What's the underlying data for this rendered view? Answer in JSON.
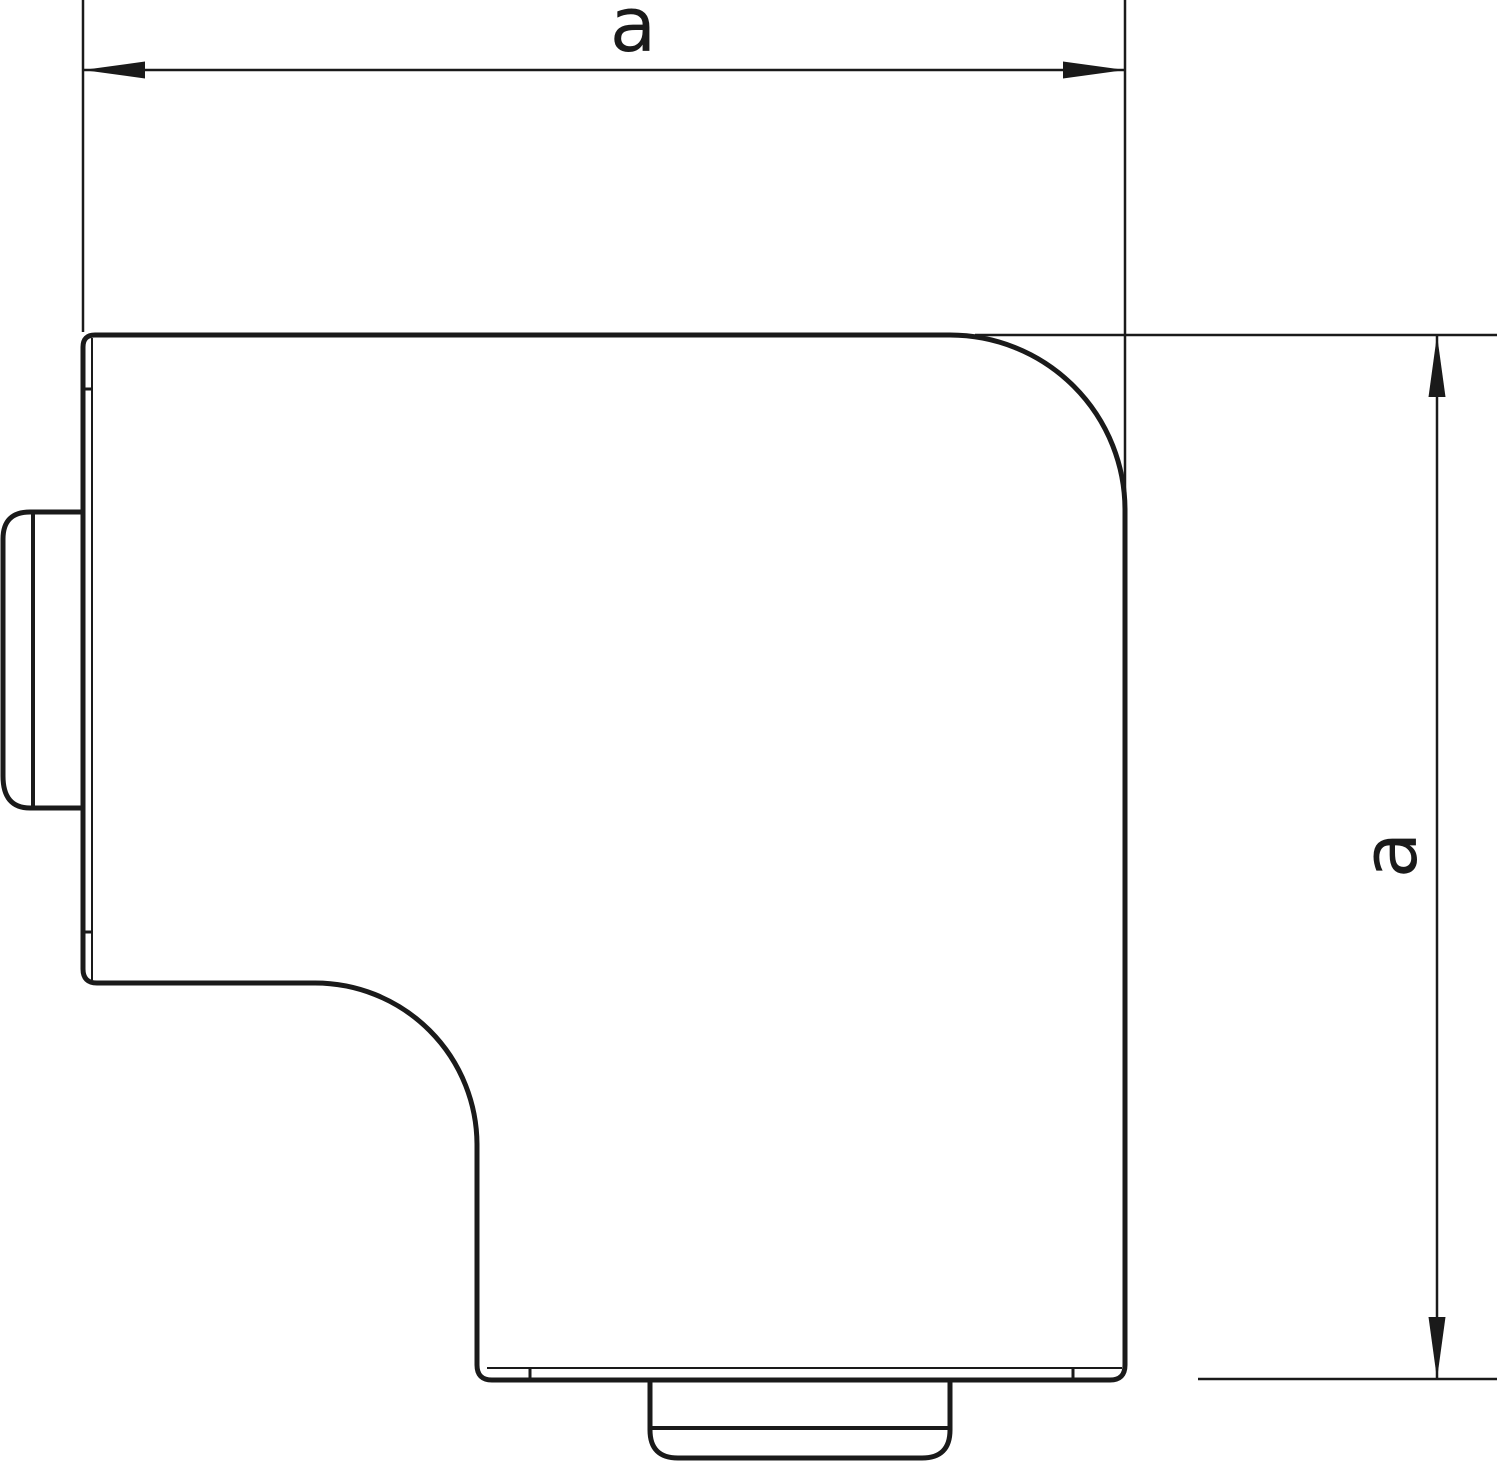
{
  "drawing": {
    "colors": {
      "background": "#ffffff",
      "line": "#1a1a1a",
      "fill": "#ffffff"
    },
    "labels": {
      "width_dimension": "a",
      "height_dimension": "a"
    }
  }
}
